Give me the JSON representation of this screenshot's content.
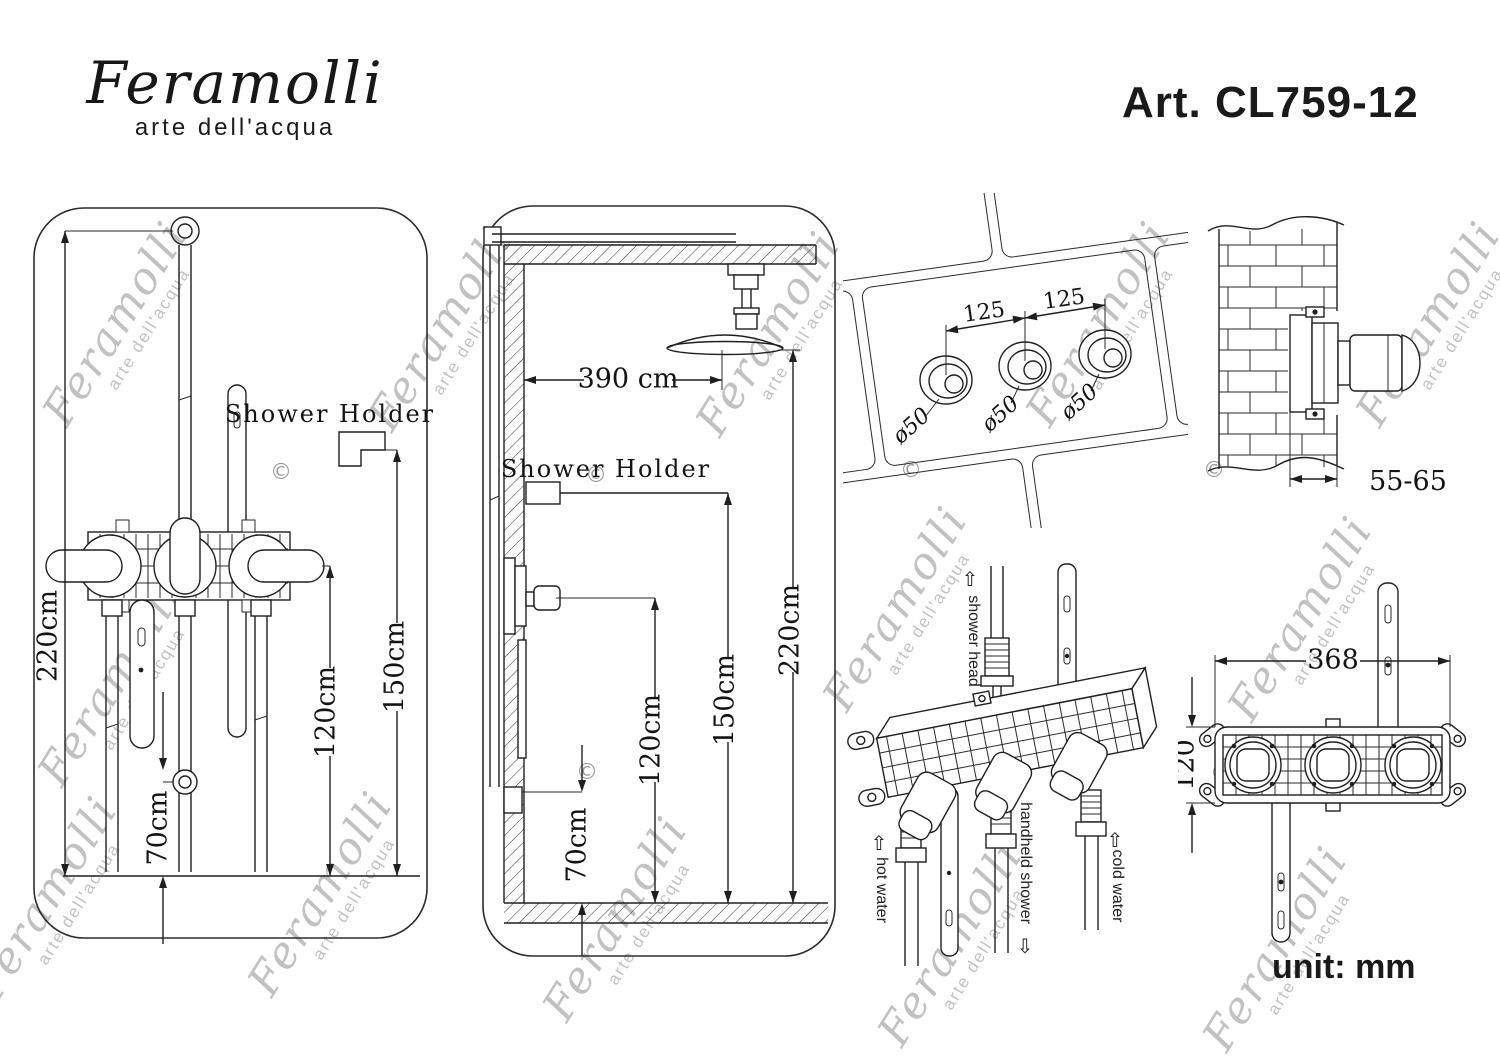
{
  "header": {
    "brand": "Feramolli",
    "tagline": "arte dell'acqua",
    "art_number": "Art. CL759-12"
  },
  "watermark": {
    "brand": "Feramolli",
    "tagline": "arte dell'acqua",
    "copyright": "©"
  },
  "front_view": {
    "shower_holder_label": "Shower Holder",
    "dim_height": "220cm",
    "dim_holder": "150cm",
    "dim_mixer": "120cm",
    "dim_handshower": "70cm"
  },
  "side_view": {
    "shower_holder_label": "Shower Holder",
    "dim_ceiling_arm": "390 cm",
    "dim_height": "220cm",
    "dim_holder": "150cm",
    "dim_mixer": "120cm",
    "dim_outlet": "70cm"
  },
  "wall_drilling": {
    "dim_spacing_left": "125",
    "dim_spacing_right": "125",
    "dim_hole_diameter": "ø50"
  },
  "wall_section": {
    "dim_embed_depth": "55-65"
  },
  "valve_3d": {
    "label_shower_head": "shower head",
    "label_hot_water": "hot water",
    "label_handheld_shower": "handheld shower",
    "label_cold_water": "cold water",
    "arrow_up": "⇧",
    "arrow_down": "⇩"
  },
  "valve_front": {
    "dim_width": "368",
    "dim_height": "120"
  },
  "footer": {
    "unit_note": "unit: mm"
  }
}
